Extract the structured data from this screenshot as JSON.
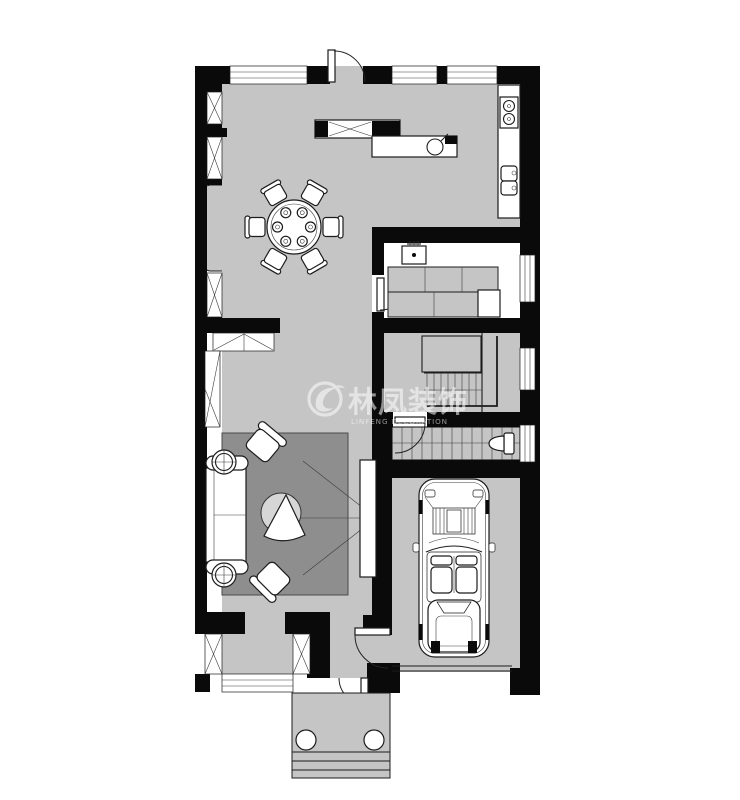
{
  "watermark": {
    "brand_cn": "林凤装饰",
    "brand_en": "LINFENG DECORATION"
  },
  "colors": {
    "wall": "#0a0a0a",
    "floor": "#c5c5c5",
    "rug": "#8e8e8e",
    "fixture": "#ffffff",
    "line": "#1c1c1c",
    "outside": "#ffffff",
    "watermark": "#ffffff",
    "tabletop": "#d6d6d6"
  }
}
